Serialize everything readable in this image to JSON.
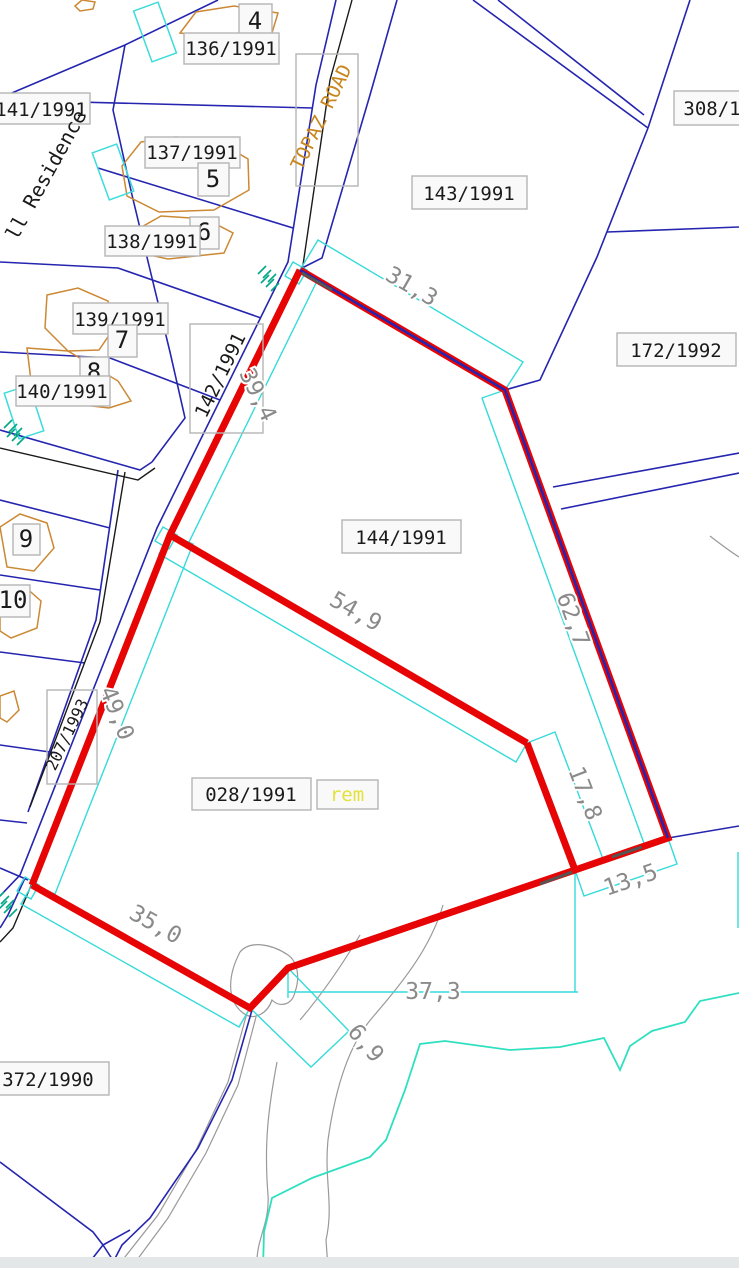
{
  "map": {
    "type": "cadastral-survey-plan",
    "road_name": "TOPAZ ROAD",
    "residence_text": "ll Residence",
    "highlighted_parcel": {
      "id": "028/1991",
      "suffix": "rem"
    },
    "parcel_ids": [
      "136/1991",
      "137/1991",
      "138/1991",
      "139/1991",
      "140/1991",
      "141/1991",
      "142/1991",
      "143/1991",
      "144/1991",
      "172/1992",
      "207/1993",
      "308/1",
      "372/1990",
      "028/1991"
    ],
    "lot_numbers": [
      "4",
      "5",
      "6",
      "7",
      "8",
      "9",
      "10"
    ],
    "dimension_values_m": [
      "31,3",
      "39,4",
      "49,0",
      "54,9",
      "62,7",
      "17,8",
      "13,5",
      "35,0",
      "37,3",
      "6,9"
    ]
  },
  "colors": {
    "parcel_line": "#2525b0",
    "boundary_black": "#1a1a1a",
    "dimension_line": "#35dada",
    "dim_text": "#8a8a8a",
    "highlight_red": "#e60404",
    "building": "#cc8833",
    "water": "#2fe0c0",
    "hatch": "#00a884",
    "contour": "#999999",
    "road_label": "#c8861e",
    "rem_yellow": "#e2e23a",
    "label_text": "#1a1a1a",
    "label_box_fill": "#f9f9f9",
    "label_box_border": "#b5b5b5"
  },
  "labels": [
    {
      "name": "lot-number-4",
      "text": "4",
      "x": 255,
      "y": 29,
      "fs": 24,
      "box": [
        239,
        4,
        33,
        34
      ]
    },
    {
      "name": "parcel-label-136-1991",
      "text": "136/1991",
      "x": 231,
      "y": 55,
      "fs": 19,
      "box": [
        184,
        33,
        95,
        31
      ]
    },
    {
      "name": "parcel-label-141-1991",
      "text": "141/1991",
      "x": 41,
      "y": 116,
      "fs": 19,
      "box": [
        -8,
        93,
        98,
        31
      ]
    },
    {
      "name": "parcel-label-137-1991",
      "text": "137/1991",
      "x": 192,
      "y": 159,
      "fs": 19,
      "box": [
        145,
        137,
        95,
        31
      ]
    },
    {
      "name": "lot-number-5",
      "text": "5",
      "x": 213,
      "y": 187,
      "fs": 24,
      "box": [
        198,
        163,
        31,
        33
      ]
    },
    {
      "name": "lot-number-6",
      "text": "6",
      "x": 204,
      "y": 240,
      "fs": 24,
      "box": [
        190,
        217,
        29,
        32
      ]
    },
    {
      "name": "parcel-label-138-1991",
      "text": "138/1991",
      "x": 152,
      "y": 248,
      "fs": 19,
      "box": [
        105,
        226,
        95,
        30
      ]
    },
    {
      "name": "parcel-label-139-1991",
      "text": "139/1991",
      "x": 120,
      "y": 326,
      "fs": 19,
      "box": [
        73,
        303,
        95,
        31
      ]
    },
    {
      "name": "lot-number-7",
      "text": "7",
      "x": 122,
      "y": 348,
      "fs": 24,
      "box": [
        108,
        325,
        29,
        32
      ]
    },
    {
      "name": "lot-number-8",
      "text": "8",
      "x": 94,
      "y": 380,
      "fs": 24,
      "box": [
        80,
        357,
        29,
        32
      ]
    },
    {
      "name": "parcel-label-140-1991",
      "text": "140/1991",
      "x": 62,
      "y": 398,
      "fs": 19,
      "box": [
        16,
        376,
        94,
        30
      ]
    },
    {
      "name": "lot-number-9",
      "text": "9",
      "x": 26,
      "y": 547,
      "fs": 24,
      "box": [
        13,
        524,
        27,
        31
      ]
    },
    {
      "name": "lot-number-10",
      "text": "10",
      "x": 13,
      "y": 608,
      "fs": 24,
      "box": [
        -4,
        585,
        34,
        32
      ]
    },
    {
      "name": "parcel-label-143-1991",
      "text": "143/1991",
      "x": 469,
      "y": 200,
      "fs": 19,
      "box": [
        412,
        176,
        115,
        33
      ]
    },
    {
      "name": "parcel-label-308-1",
      "text": "308/1",
      "x": 712,
      "y": 115,
      "fs": 19,
      "box": [
        674,
        91,
        80,
        34
      ]
    },
    {
      "name": "parcel-label-172-1992",
      "text": "172/1992",
      "x": 676,
      "y": 357,
      "fs": 19,
      "box": [
        617,
        333,
        119,
        33
      ]
    },
    {
      "name": "parcel-label-144-1991",
      "text": "144/1991",
      "x": 401,
      "y": 544,
      "fs": 19,
      "box": [
        342,
        520,
        119,
        33
      ]
    },
    {
      "name": "parcel-label-028-1991",
      "text": "028/1991",
      "x": 251,
      "y": 801,
      "fs": 19,
      "box": [
        192,
        778,
        119,
        32
      ]
    },
    {
      "name": "parcel-label-028-rem",
      "text": "rem",
      "x": 347,
      "y": 801,
      "fs": 19,
      "fill": "rem_yellow",
      "box": [
        317,
        780,
        61,
        29
      ]
    },
    {
      "name": "parcel-label-372-1990",
      "text": "372/1990",
      "x": 48,
      "y": 1086,
      "fs": 19,
      "box": [
        -14,
        1062,
        123,
        33
      ]
    },
    {
      "name": "parcel-label-142-1991",
      "text": "142/1991",
      "x": 226,
      "y": 378,
      "fs": 19,
      "rot": -64,
      "box": [
        190,
        324,
        73,
        109
      ],
      "boxfill": "none"
    },
    {
      "name": "parcel-label-207-1993",
      "text": "207/1993",
      "x": 72,
      "y": 737,
      "fs": 16,
      "rot": -64,
      "box": [
        47,
        690,
        50,
        94
      ],
      "boxfill": "none"
    },
    {
      "name": "road-label-topaz-road",
      "text": "TOPAZ ROAD",
      "x": 327,
      "y": 120,
      "fs": 19,
      "rot": -64,
      "fill": "road_label",
      "box": [
        296,
        54,
        62,
        132
      ],
      "boxfill": "none"
    },
    {
      "name": "residence-label",
      "text": "ll Residence",
      "x": 52,
      "y": 178,
      "fs": 20,
      "rot": -61
    },
    {
      "name": "dimension-31-3",
      "text": "31,3",
      "x": 408,
      "y": 293,
      "fs": 23,
      "rot": 30,
      "fill": "dim_text",
      "halo": true
    },
    {
      "name": "dimension-39-4",
      "text": "39,4",
      "x": 251,
      "y": 398,
      "fs": 23,
      "rot": 64,
      "fill": "dim_text",
      "halo": true
    },
    {
      "name": "dimension-49-0",
      "text": "49,0",
      "x": 110,
      "y": 716,
      "fs": 23,
      "rot": 68,
      "fill": "dim_text",
      "halo": true
    },
    {
      "name": "dimension-54-9",
      "text": "54,9",
      "x": 352,
      "y": 618,
      "fs": 23,
      "rot": 30,
      "fill": "dim_text",
      "halo": true
    },
    {
      "name": "dimension-62-7",
      "text": "62,7",
      "x": 566,
      "y": 622,
      "fs": 23,
      "rot": 70,
      "fill": "dim_text",
      "halo": true
    },
    {
      "name": "dimension-17-8",
      "text": "17,8",
      "x": 578,
      "y": 796,
      "fs": 23,
      "rot": 69,
      "fill": "dim_text",
      "halo": true
    },
    {
      "name": "dimension-13-5",
      "text": "13,5",
      "x": 633,
      "y": 887,
      "fs": 23,
      "rot": -19,
      "fill": "dim_text",
      "halo": true
    },
    {
      "name": "dimension-35-0",
      "text": "35,0",
      "x": 152,
      "y": 931,
      "fs": 23,
      "rot": 29,
      "fill": "dim_text",
      "halo": true
    },
    {
      "name": "dimension-37-3",
      "text": "37,3",
      "x": 433,
      "y": 999,
      "fs": 23,
      "rot": 0,
      "fill": "dim_text",
      "halo": true
    },
    {
      "name": "dimension-6-9",
      "text": "6,9",
      "x": 360,
      "y": 1048,
      "fs": 23,
      "rot": 50,
      "fill": "dim_text",
      "halo": true
    }
  ]
}
